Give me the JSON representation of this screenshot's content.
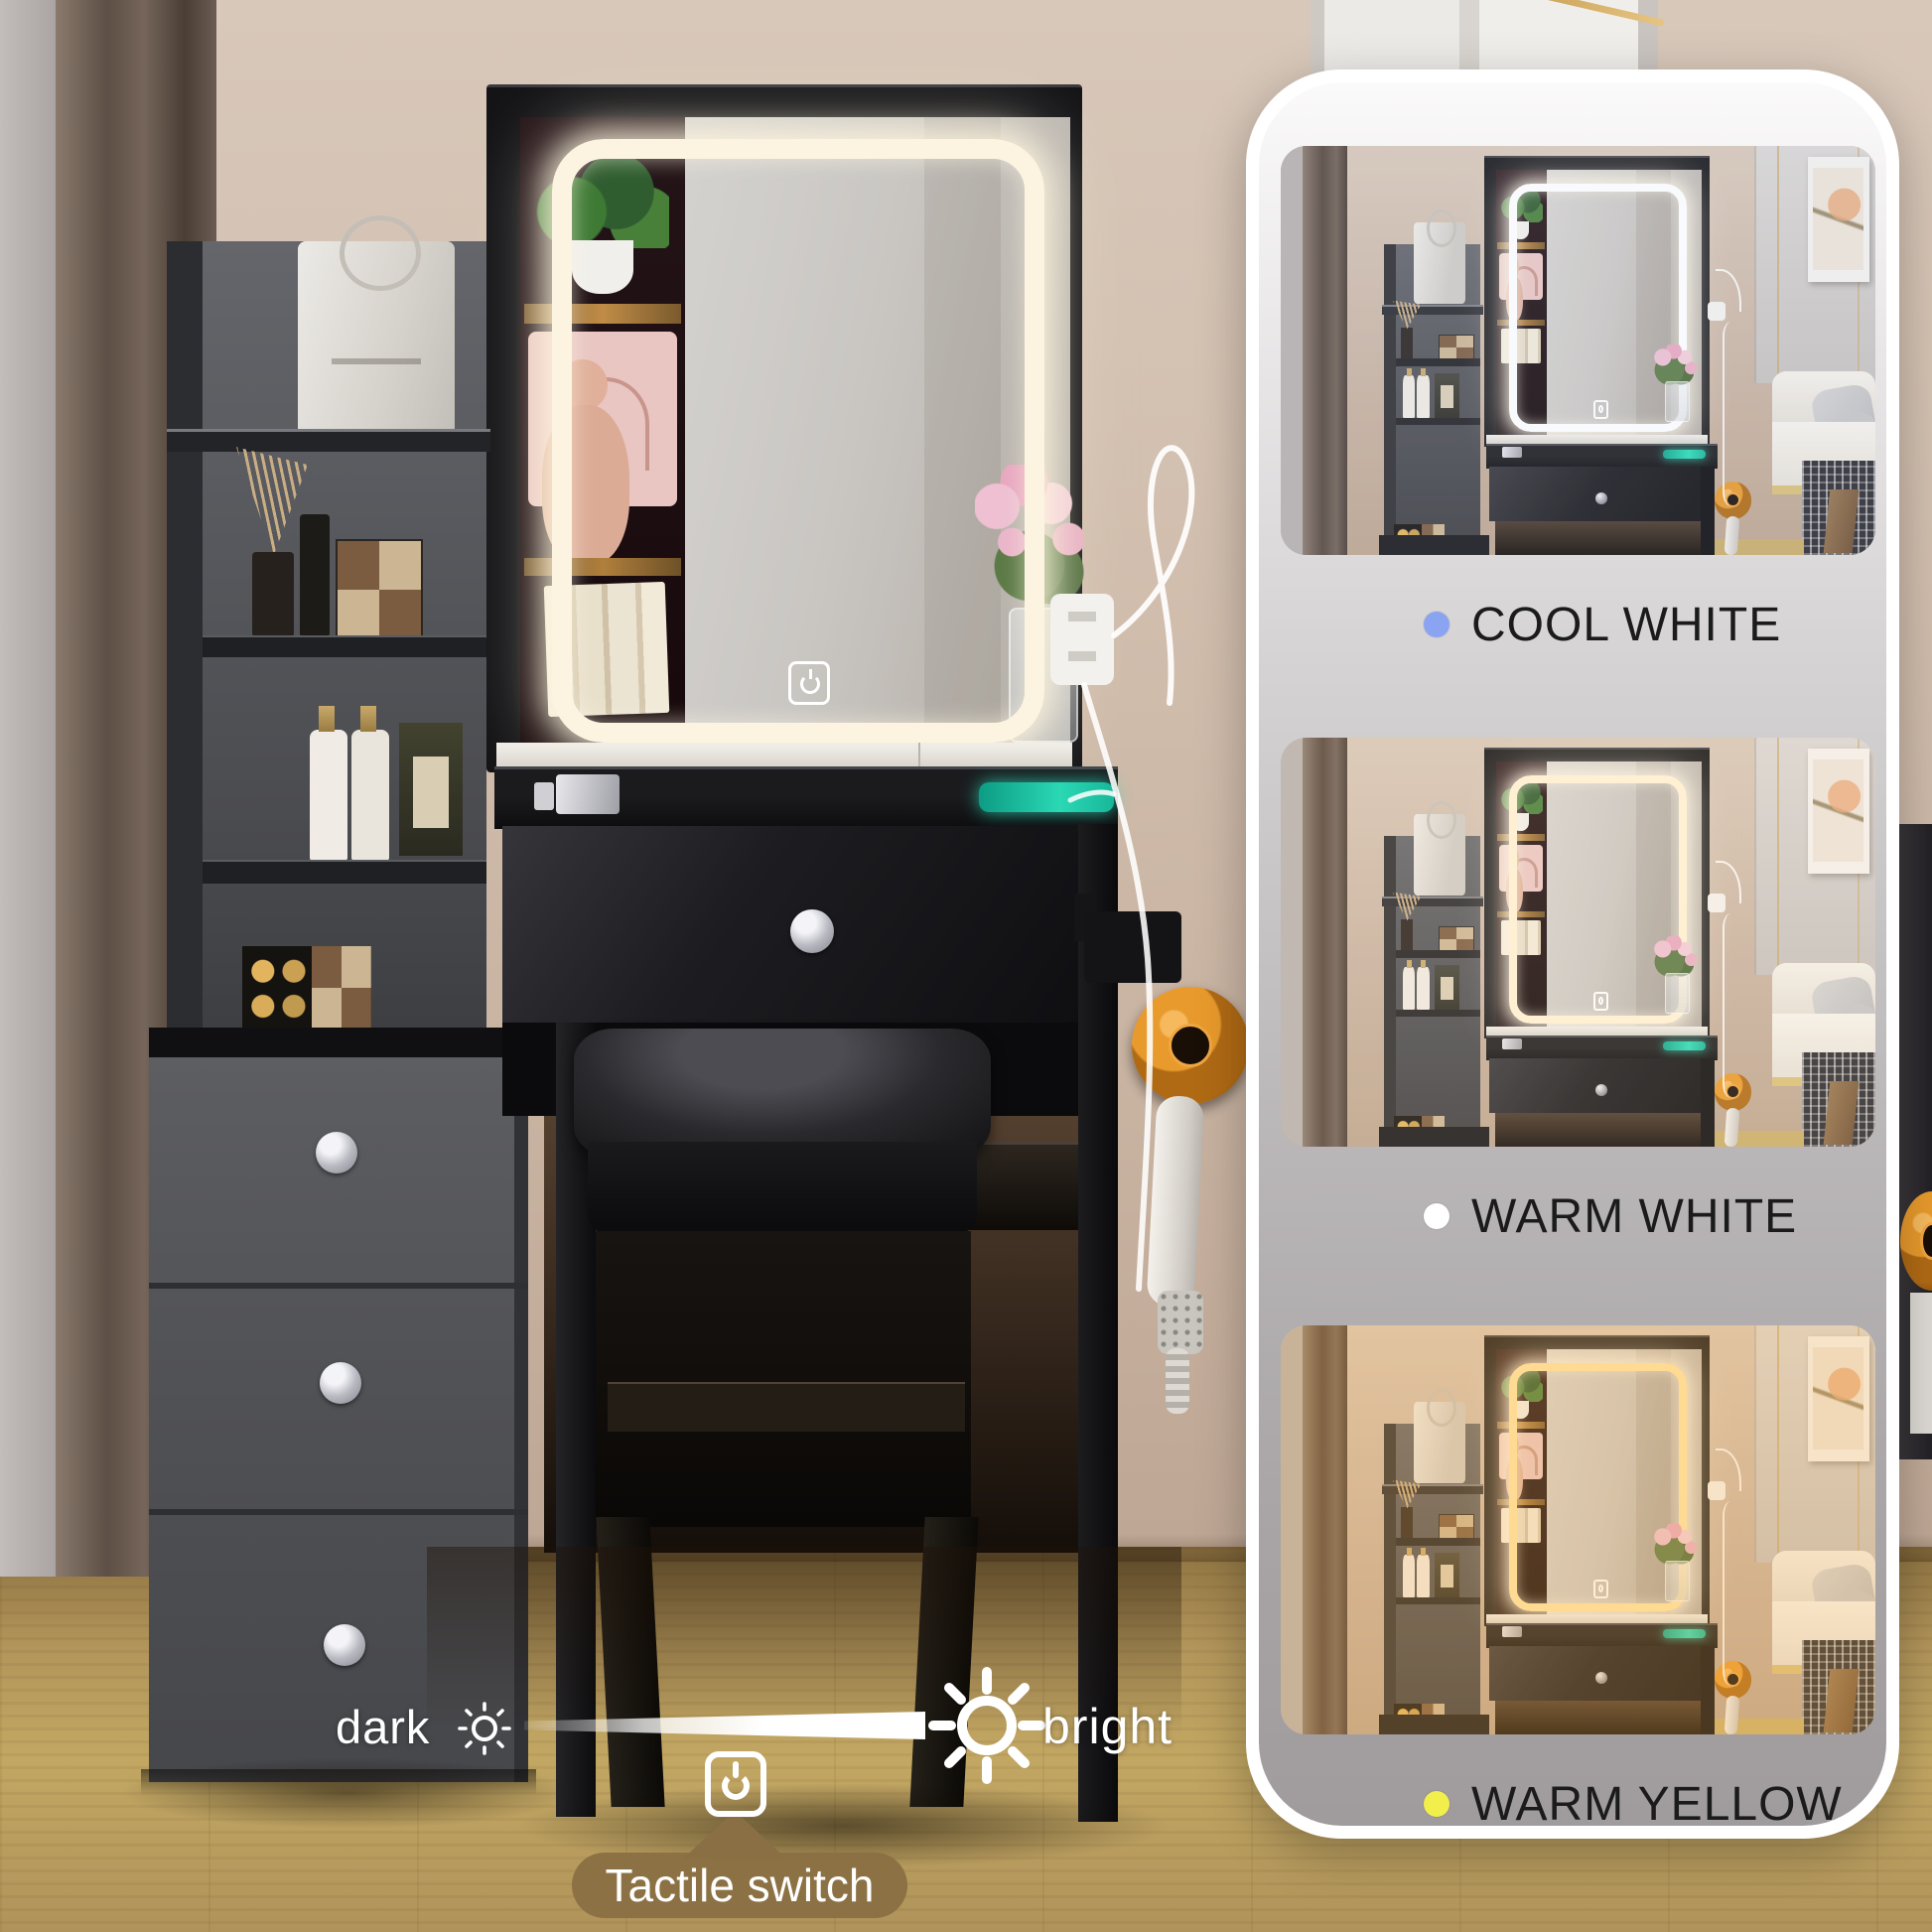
{
  "panel": {
    "modes": [
      {
        "id": "cool-white",
        "label": "COOL WHITE",
        "dot_color": "#8aa4f2",
        "led_color": "#ffffff",
        "tint": "rgba(205,216,235,0.12)"
      },
      {
        "id": "warm-white",
        "label": "WARM WHITE",
        "dot_color": "#ffffff",
        "led_color": "#fff3d8",
        "tint": "rgba(255,226,188,0.14)"
      },
      {
        "id": "warm-yellow",
        "label": "WARM YELLOW",
        "dot_color": "#f2ef4d",
        "led_color": "#ffe6a6",
        "tint": "rgba(255,184,90,0.26)"
      }
    ]
  },
  "brightness": {
    "dark_label": "dark",
    "bright_label": "bright"
  },
  "switch": {
    "label": "Tactile switch"
  },
  "icons": {
    "dim_sun_icon": "☼",
    "bright_sun_icon": "☀",
    "power_icon": "⏻",
    "touch_sensor_icon": "⏻"
  },
  "colors": {
    "badge": "#8a6f44",
    "label_text": "#1b1b1b",
    "card_top": "#fbfafa",
    "card_bottom": "#a09c9e",
    "wall": "#c9b5a4",
    "floor": "#b3965c",
    "furniture_black": "#141417",
    "drawer_gray": "#55565b",
    "dryer_orange": "#e89a2c",
    "charger_teal": "#1fc7a6",
    "led_glow": "#fdf3dd"
  }
}
